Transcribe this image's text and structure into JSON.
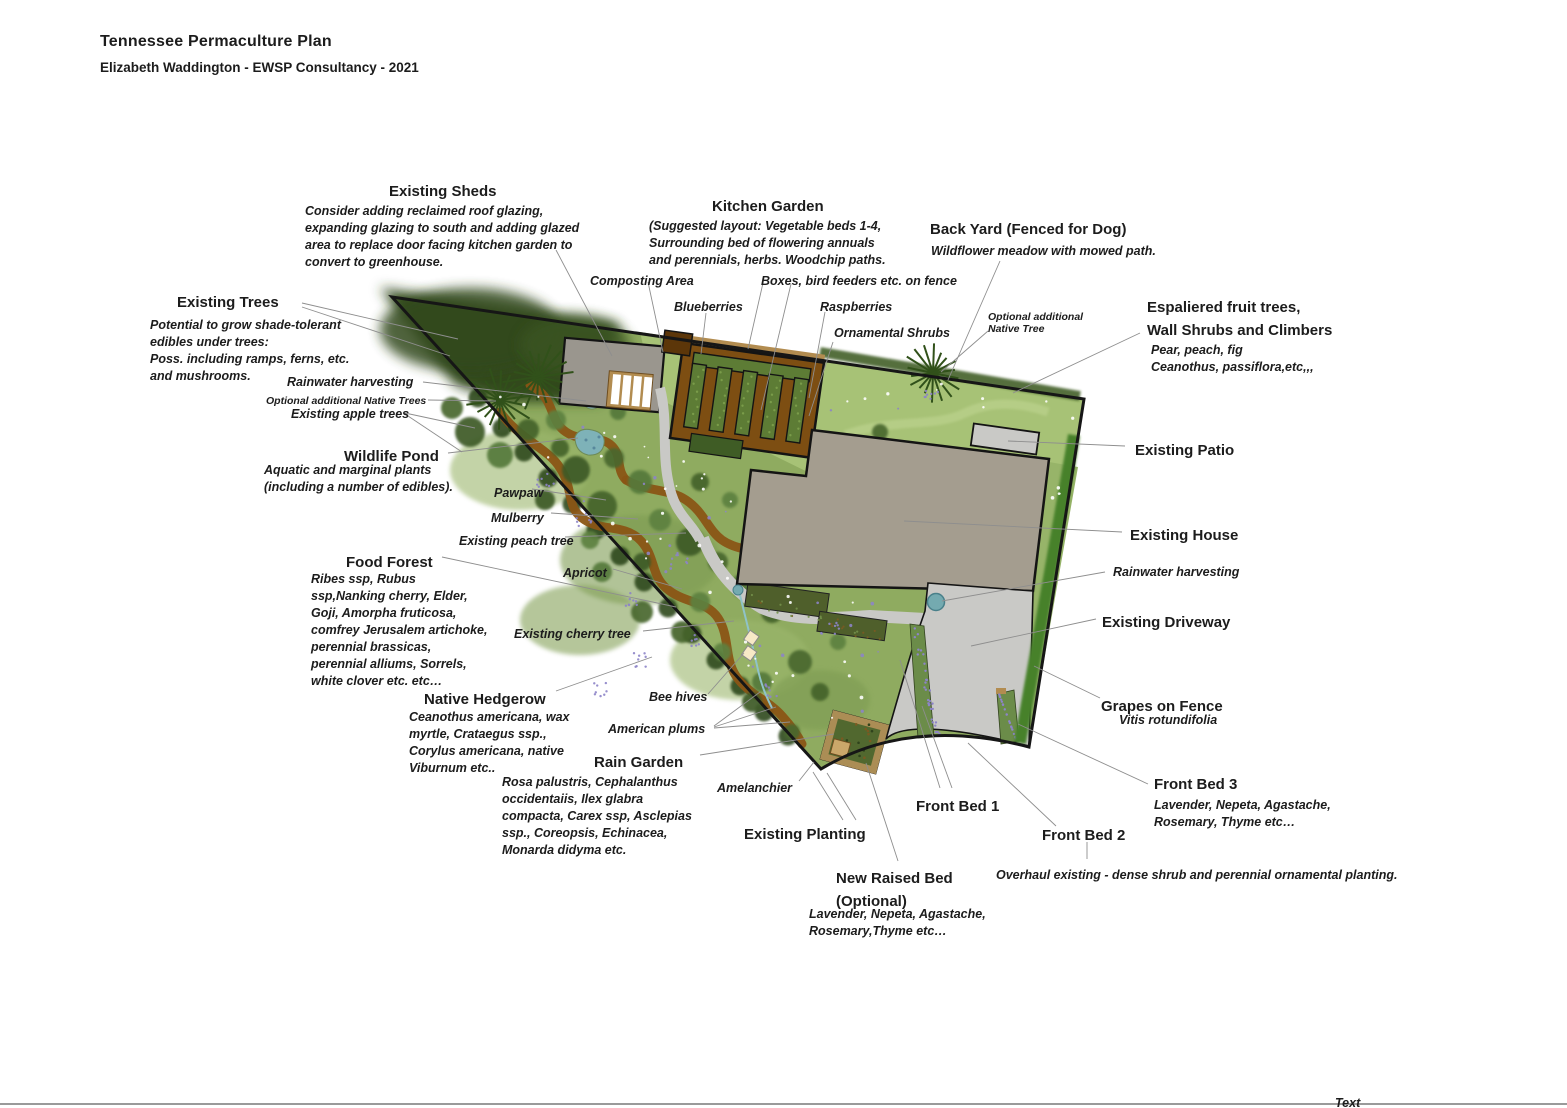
{
  "header": {
    "title": "Tennessee Permaculture Plan",
    "subtitle": "Elizabeth Waddington - EWSP Consultancy - 2021"
  },
  "footer": {
    "cut_label": "Text"
  },
  "colors": {
    "woodland": "#32491d",
    "food_forest": "#8fab60",
    "meadow": "#a7c276",
    "path_brown": "#8a5515",
    "kitchen_garden_soil": "#7d4e12",
    "bed_green": "#5d7c35",
    "house": "#a49d8f",
    "shed": "#9a968e",
    "paving": "#c9c9c6",
    "pond": "#7eb2b8",
    "flower_purple": "#8d84c8",
    "hedge_dark": "#2e481b",
    "outline": "#161616",
    "leader": "#8e8e8e",
    "tan": "#b28c50",
    "hive_cream": "#f7e9c6",
    "barrel_teal": "#74aab0"
  },
  "labels": [
    {
      "id": "existing-sheds-heading",
      "cls": "h",
      "x": 389,
      "y": 180,
      "lines": [
        "Existing Sheds"
      ]
    },
    {
      "id": "existing-sheds-note",
      "cls": "note",
      "x": 305,
      "y": 203,
      "lines": [
        "Consider adding reclaimed roof glazing,",
        "expanding glazing to south and adding glazed",
        "area to replace door facing kitchen garden to",
        "convert to greenhouse."
      ]
    },
    {
      "id": "kitchen-garden-heading",
      "cls": "h",
      "x": 712,
      "y": 195,
      "lines": [
        "Kitchen Garden"
      ]
    },
    {
      "id": "kitchen-garden-note",
      "cls": "note",
      "x": 649,
      "y": 218,
      "lines": [
        "(Suggested layout: Vegetable beds 1-4,",
        "Surrounding bed of flowering annuals",
        "and perennials, herbs. Woodchip paths."
      ]
    },
    {
      "id": "composting-area",
      "cls": "map",
      "x": 590,
      "y": 273,
      "lines": [
        "Composting Area"
      ]
    },
    {
      "id": "blueberries",
      "cls": "map",
      "x": 674,
      "y": 299,
      "lines": [
        "Blueberries"
      ]
    },
    {
      "id": "boxes-bird-feeders",
      "cls": "map",
      "x": 761,
      "y": 273,
      "lines": [
        "Boxes, bird feeders etc. on fence"
      ]
    },
    {
      "id": "raspberries",
      "cls": "map",
      "x": 820,
      "y": 299,
      "lines": [
        "Raspberries"
      ]
    },
    {
      "id": "ornamental-shrubs",
      "cls": "map",
      "x": 834,
      "y": 325,
      "lines": [
        "Ornamental Shrubs"
      ]
    },
    {
      "id": "back-yard-heading",
      "cls": "h",
      "x": 930,
      "y": 218,
      "lines": [
        "Back Yard (Fenced for Dog)"
      ]
    },
    {
      "id": "back-yard-note",
      "cls": "note",
      "x": 931,
      "y": 243,
      "lines": [
        "Wildflower meadow with mowed path."
      ]
    },
    {
      "id": "optional-native-tree-right",
      "cls": "tiny",
      "x": 988,
      "y": 311,
      "lines": [
        "Optional additional",
        "Native Tree"
      ]
    },
    {
      "id": "espaliered-heading",
      "cls": "h",
      "x": 1147,
      "y": 296,
      "lines": [
        "Espaliered fruit trees,",
        "Wall Shrubs and Climbers"
      ]
    },
    {
      "id": "espaliered-note",
      "cls": "note",
      "x": 1151,
      "y": 342,
      "lines": [
        "Pear, peach, fig",
        "Ceanothus, passiflora,etc,,,"
      ]
    },
    {
      "id": "existing-trees-heading",
      "cls": "h",
      "x": 177,
      "y": 291,
      "lines": [
        "Existing Trees"
      ]
    },
    {
      "id": "existing-trees-note",
      "cls": "note",
      "x": 150,
      "y": 317,
      "lines": [
        "Potential to grow shade-tolerant",
        "edibles under trees:",
        "Poss. including ramps, ferns, etc.",
        "and mushrooms."
      ]
    },
    {
      "id": "rainwater-harvesting-left",
      "cls": "map",
      "x": 287,
      "y": 374,
      "lines": [
        "Rainwater harvesting"
      ]
    },
    {
      "id": "optional-native-trees-left",
      "cls": "tiny",
      "x": 266,
      "y": 395,
      "lines": [
        "Optional additional Native Trees"
      ]
    },
    {
      "id": "existing-apple-trees",
      "cls": "map",
      "x": 291,
      "y": 406,
      "lines": [
        "Existing apple trees"
      ]
    },
    {
      "id": "wildlife-pond-heading",
      "cls": "h",
      "x": 344,
      "y": 445,
      "lines": [
        "Wildlife Pond"
      ]
    },
    {
      "id": "wildlife-pond-note",
      "cls": "note",
      "x": 264,
      "y": 462,
      "lines": [
        "Aquatic and marginal plants",
        "(including a number of edibles)."
      ]
    },
    {
      "id": "pawpaw",
      "cls": "map",
      "x": 494,
      "y": 485,
      "lines": [
        "Pawpaw"
      ]
    },
    {
      "id": "mulberry",
      "cls": "map",
      "x": 491,
      "y": 510,
      "lines": [
        "Mulberry"
      ]
    },
    {
      "id": "existing-peach-tree",
      "cls": "map",
      "x": 459,
      "y": 533,
      "lines": [
        "Existing peach tree"
      ]
    },
    {
      "id": "apricot",
      "cls": "map",
      "x": 563,
      "y": 565,
      "lines": [
        "Apricot"
      ]
    },
    {
      "id": "food-forest-heading",
      "cls": "h",
      "x": 346,
      "y": 551,
      "lines": [
        "Food Forest"
      ]
    },
    {
      "id": "food-forest-note",
      "cls": "note",
      "x": 311,
      "y": 571,
      "lines": [
        "Ribes ssp, Rubus",
        "ssp,Nanking cherry, Elder,",
        "Goji, Amorpha fruticosa,",
        "comfrey Jerusalem artichoke,",
        "perennial brassicas,",
        "perennial alliums, Sorrels,",
        "white clover etc. etc…"
      ]
    },
    {
      "id": "existing-cherry-tree",
      "cls": "map",
      "x": 514,
      "y": 626,
      "lines": [
        "Existing cherry tree"
      ]
    },
    {
      "id": "native-hedgerow-heading",
      "cls": "h",
      "x": 424,
      "y": 688,
      "lines": [
        "Native Hedgerow"
      ]
    },
    {
      "id": "native-hedgerow-note",
      "cls": "note",
      "x": 409,
      "y": 709,
      "lines": [
        "Ceanothus americana, wax",
        "myrtle, Crataegus ssp.,",
        "Corylus americana, native",
        "Viburnum etc.."
      ]
    },
    {
      "id": "bee-hives",
      "cls": "map",
      "x": 649,
      "y": 689,
      "lines": [
        "Bee hives"
      ]
    },
    {
      "id": "american-plums",
      "cls": "map",
      "x": 608,
      "y": 721,
      "lines": [
        "American plums"
      ]
    },
    {
      "id": "rain-garden-heading",
      "cls": "h",
      "x": 594,
      "y": 751,
      "lines": [
        "Rain Garden"
      ]
    },
    {
      "id": "rain-garden-note",
      "cls": "note",
      "x": 502,
      "y": 774,
      "lines": [
        "Rosa palustris, Cephalanthus",
        "occidentaiis, Ilex glabra",
        "compacta, Carex ssp, Asclepias",
        "ssp., Coreopsis, Echinacea,",
        "Monarda didyma etc."
      ]
    },
    {
      "id": "amelanchier",
      "cls": "map",
      "x": 717,
      "y": 780,
      "lines": [
        "Amelanchier"
      ]
    },
    {
      "id": "existing-planting-heading",
      "cls": "h",
      "x": 744,
      "y": 823,
      "lines": [
        "Existing Planting"
      ]
    },
    {
      "id": "front-bed-1-heading",
      "cls": "h",
      "x": 916,
      "y": 795,
      "lines": [
        "Front Bed 1"
      ]
    },
    {
      "id": "front-bed-2-heading",
      "cls": "h",
      "x": 1042,
      "y": 824,
      "lines": [
        "Front Bed 2"
      ]
    },
    {
      "id": "new-raised-bed-heading",
      "cls": "h",
      "x": 836,
      "y": 867,
      "lines": [
        "New Raised Bed",
        "(Optional)"
      ]
    },
    {
      "id": "new-raised-bed-note",
      "cls": "note",
      "x": 809,
      "y": 906,
      "lines": [
        "Lavender, Nepeta, Agastache,",
        "Rosemary,Thyme etc…"
      ]
    },
    {
      "id": "overhaul-note",
      "cls": "note",
      "x": 996,
      "y": 867,
      "lines": [
        "Overhaul existing - dense shrub and perennial ornamental planting."
      ]
    },
    {
      "id": "front-bed-3-heading",
      "cls": "h",
      "x": 1154,
      "y": 773,
      "lines": [
        "Front Bed 3"
      ]
    },
    {
      "id": "front-bed-3-note",
      "cls": "note",
      "x": 1154,
      "y": 797,
      "lines": [
        "Lavender, Nepeta, Agastache,",
        "Rosemary, Thyme etc…"
      ]
    },
    {
      "id": "grapes-heading",
      "cls": "h",
      "x": 1101,
      "y": 695,
      "lines": [
        "Grapes on Fence"
      ]
    },
    {
      "id": "grapes-note",
      "cls": "note",
      "x": 1119,
      "y": 712,
      "lines": [
        "Vitis rotundifolia"
      ]
    },
    {
      "id": "existing-patio-heading",
      "cls": "h",
      "x": 1135,
      "y": 439,
      "lines": [
        "Existing Patio"
      ]
    },
    {
      "id": "existing-house-heading",
      "cls": "h",
      "x": 1130,
      "y": 524,
      "lines": [
        "Existing House"
      ]
    },
    {
      "id": "rainwater-harvesting-right",
      "cls": "map",
      "x": 1113,
      "y": 564,
      "lines": [
        "Rainwater harvesting"
      ]
    },
    {
      "id": "existing-driveway-heading",
      "cls": "h",
      "x": 1102,
      "y": 611,
      "lines": [
        "Existing Driveway"
      ]
    }
  ],
  "leader_lines": [
    [
      556,
      250,
      612,
      356
    ],
    [
      302,
      303,
      458,
      339
    ],
    [
      302,
      307,
      450,
      356
    ],
    [
      423,
      382,
      586,
      401
    ],
    [
      428,
      400,
      496,
      401
    ],
    [
      405,
      413,
      475,
      428
    ],
    [
      405,
      414,
      462,
      452
    ],
    [
      448,
      453,
      578,
      438
    ],
    [
      532,
      489,
      606,
      500
    ],
    [
      551,
      513,
      638,
      519
    ],
    [
      565,
      537,
      686,
      533
    ],
    [
      613,
      569,
      682,
      589
    ],
    [
      442,
      557,
      676,
      607
    ],
    [
      643,
      631,
      734,
      621
    ],
    [
      556,
      691,
      652,
      657
    ],
    [
      708,
      694,
      744,
      653
    ],
    [
      714,
      726,
      760,
      692
    ],
    [
      714,
      727,
      776,
      707
    ],
    [
      714,
      728,
      790,
      722
    ],
    [
      700,
      755,
      834,
      734
    ],
    [
      799,
      781,
      814,
      762
    ],
    [
      843,
      820,
      813,
      772
    ],
    [
      856,
      820,
      827,
      773
    ],
    [
      940,
      788,
      900,
      660
    ],
    [
      952,
      788,
      922,
      706
    ],
    [
      1056,
      826,
      968,
      743
    ],
    [
      1087,
      842,
      1087,
      859
    ],
    [
      1148,
      784,
      1018,
      724
    ],
    [
      1100,
      698,
      1034,
      666
    ],
    [
      1140,
      333,
      1013,
      393
    ],
    [
      1000,
      261,
      948,
      380
    ],
    [
      833,
      342,
      809,
      416
    ],
    [
      988,
      331,
      941,
      372
    ],
    [
      648,
      282,
      663,
      352
    ],
    [
      706,
      313,
      701,
      354
    ],
    [
      763,
      283,
      748,
      349
    ],
    [
      791,
      284,
      761,
      410
    ],
    [
      825,
      312,
      809,
      398
    ],
    [
      1125,
      446,
      1008,
      441
    ],
    [
      1122,
      532,
      904,
      521
    ],
    [
      1105,
      572,
      942,
      601
    ],
    [
      1096,
      619,
      971,
      646
    ],
    [
      898,
      861,
      866,
      763
    ]
  ]
}
